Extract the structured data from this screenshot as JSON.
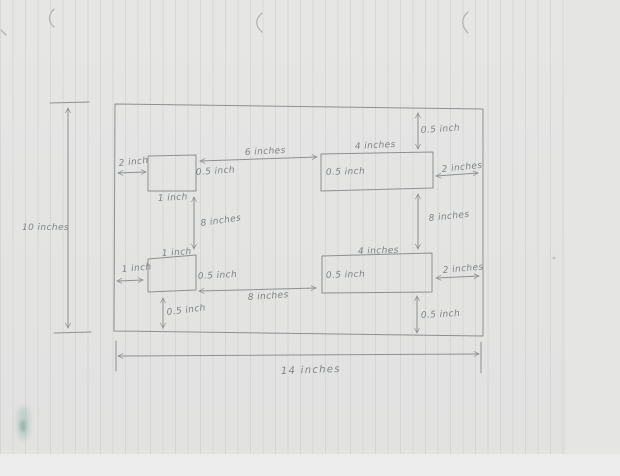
{
  "page": {
    "paper_color": "#e4e4e3",
    "rule_color": "#c9cdce",
    "ink_color": "#8d9091",
    "text_color": "#7e8386",
    "smudge_color": "#9fc0b6"
  },
  "sketch": {
    "kind": "hand-drawn dimensioned layout sketch on ruled paper",
    "overall": {
      "width": "14 inches",
      "height": "10 inches"
    },
    "labels": {
      "tl_gap_left": "2 inch",
      "tl_right": "0.5 inch",
      "tl_below": "1 inch",
      "top_gap": "6 inches",
      "mid_left_gap": "8 inches",
      "tr_width": "4 inches",
      "tr_inner": "0.5 inch",
      "tr_top_gap": "0.5 inch",
      "tr_right_gap": "2 inches",
      "mid_right_gap": "8 inches",
      "bl_above": "1 inch",
      "bl_gap_left": "1 inch",
      "bl_right": "0.5 inch",
      "bl_below": "0.5 inch",
      "bottom_gap": "8 inches",
      "br_width": "4 inches",
      "br_inner": "0.5 inch",
      "br_right_gap": "2 inches",
      "br_below": "0.5 inch"
    }
  }
}
